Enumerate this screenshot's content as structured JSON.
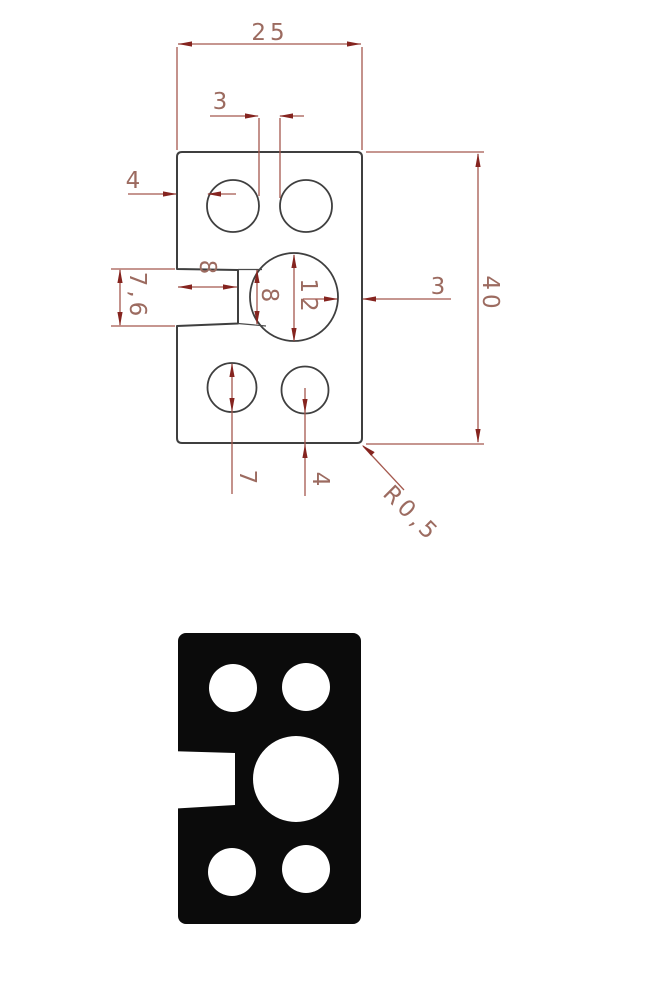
{
  "document": {
    "kind": "technical drawing of a rectangular plate with five holes and a left-side notch, shown as a dimensioned line view above and a solid black silhouette view below",
    "background": "#ffffff"
  },
  "colors": {
    "part_outline": "#3f3f3f",
    "dimension_line": "#a4584d",
    "arrowhead": "#85241f",
    "dimension_text": "#9c6b60",
    "silhouette_fill": "#0b0b0b"
  },
  "drawing": {
    "dims": {
      "overall_width": "25",
      "top_holes_gap": "3",
      "edge_to_top_hole": "4",
      "notch_opening_height": "7,6",
      "notch_depth": "8",
      "notch_inner_height": "8",
      "center_hole_diameter": "12",
      "center_hole_to_right_edge": "3",
      "overall_height": "40",
      "bottom_hole_diameter": "7",
      "bottom_hole_to_bottom_edge": "4",
      "corner_radius": "R0,5"
    }
  }
}
